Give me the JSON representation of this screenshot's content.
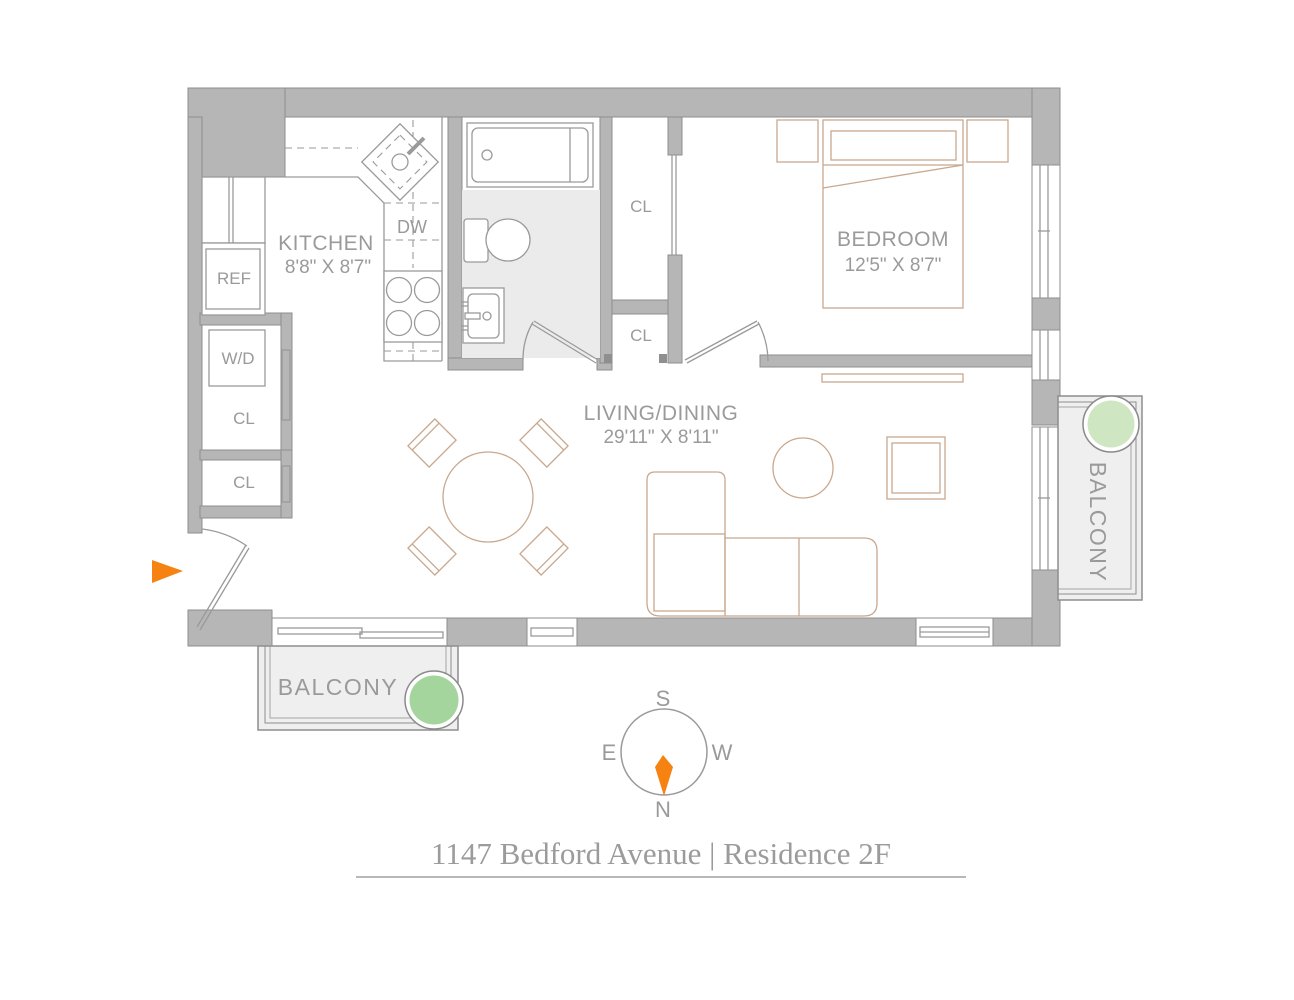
{
  "title": {
    "text": "1147 Bedford Avenue | Residence 2F"
  },
  "rooms": {
    "kitchen": {
      "name": "KITCHEN",
      "dims": "8'8\" X 8'7\""
    },
    "bedroom": {
      "name": "BEDROOM",
      "dims": "12'5\" X 8'7\""
    },
    "living_dining": {
      "name": "LIVING/DINING",
      "dims": "29'11\" X 8'11\""
    },
    "balcony_bottom": {
      "name": "BALCONY"
    },
    "balcony_right": {
      "name": "BALCONY"
    }
  },
  "fixtures": {
    "refrigerator": "REF",
    "washer_dryer": "W/D",
    "dishwasher": "DW",
    "closet": "CL"
  },
  "compass": {
    "north": "N",
    "south": "S",
    "east": "E",
    "west": "W"
  },
  "colors": {
    "wall_fill": "#b6b6b6",
    "wall_edge": "#8e8e8e",
    "line_gray": "#9a9a9a",
    "furniture_tan": "#c8a88e",
    "bathroom_floor": "#ebebeb",
    "balcony_floor": "#efefef",
    "plant_green_dark": "#a4d59c",
    "plant_green_light": "#cfe6c3",
    "accent_orange": "#f58211",
    "label_text": "#9a9a9a"
  }
}
